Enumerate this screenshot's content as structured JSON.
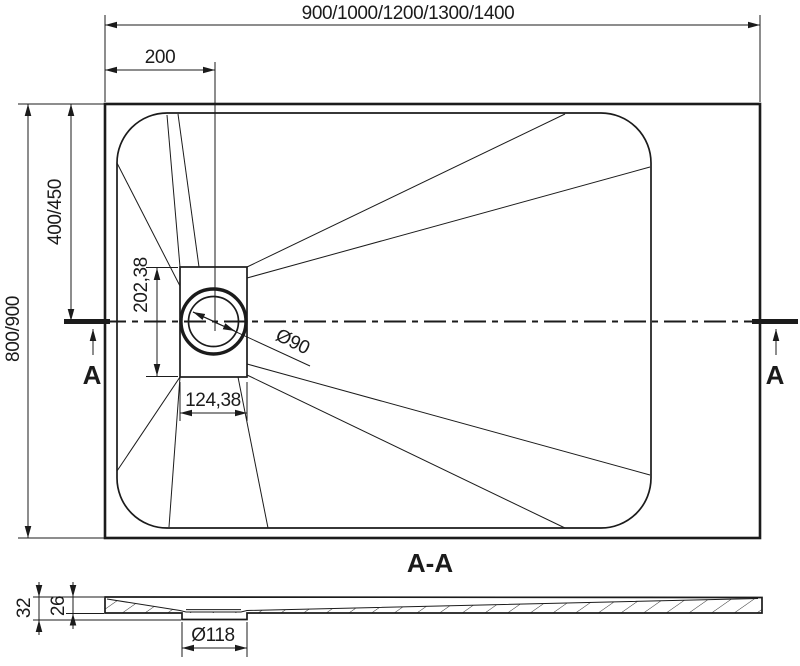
{
  "drawing": {
    "type": "shower-tray-technical-drawing",
    "colors": {
      "ink": "#1b1b1b",
      "background": "#ffffff"
    },
    "plan": {
      "width_dim": "900/1000/1200/1300/1400",
      "drain_offset_dim": "200",
      "height_dim": "800/900",
      "drain_axis_dim": "400/450",
      "drain_recess_height_dim": "202,38",
      "drain_recess_width_dim": "124,38",
      "drain_diameter_dim": "Ø90",
      "section_mark_left": "A",
      "section_mark_right": "A"
    },
    "section": {
      "title": "A-A",
      "total_height_dim": "32",
      "edge_height_dim": "26",
      "drain_hole_diameter_dim": "Ø118"
    }
  }
}
